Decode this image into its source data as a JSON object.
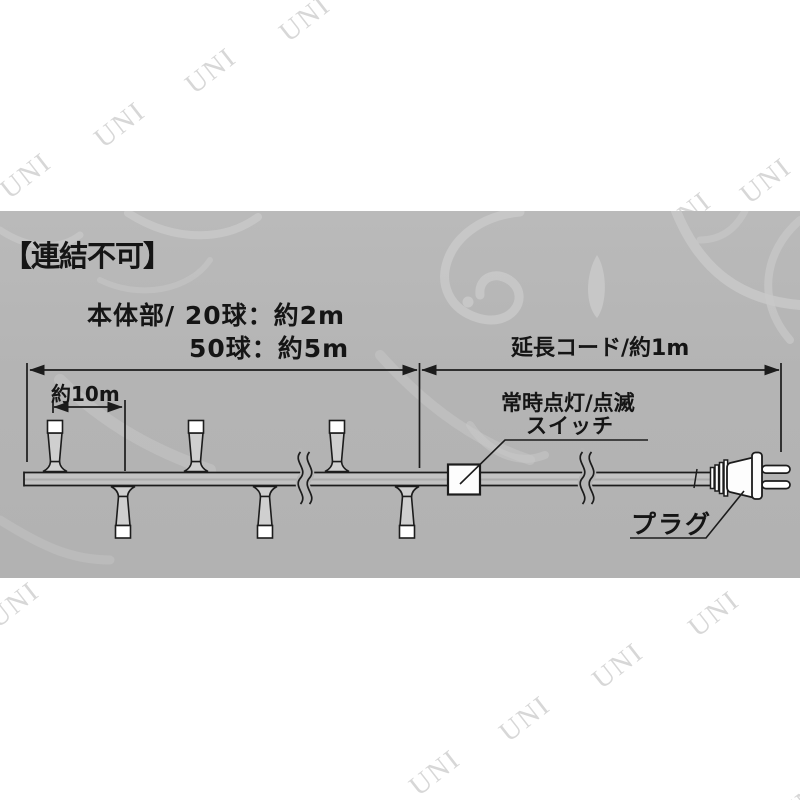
{
  "watermark": {
    "text": "UNI"
  },
  "panel": {
    "heading": "【連結不可】",
    "body_line1": "本体部/ 20球：約2m",
    "body_line2": "50球：約5m",
    "extension_label": "延長コード/約1m",
    "bulb_spacing_label": "約10m",
    "switch_label_line1": "常時点灯/点滅",
    "switch_label_line2": "スイッチ",
    "plug_label": "プラグ"
  },
  "colors": {
    "panel_bg": "#b5b5b5",
    "ink": "#1c1c1c",
    "swirl_ornament": "#c9c9c9",
    "watermark": "#d7d7d7",
    "wire_fill": "#c2c2c2",
    "bulb_fill": "#cfcfcf"
  }
}
